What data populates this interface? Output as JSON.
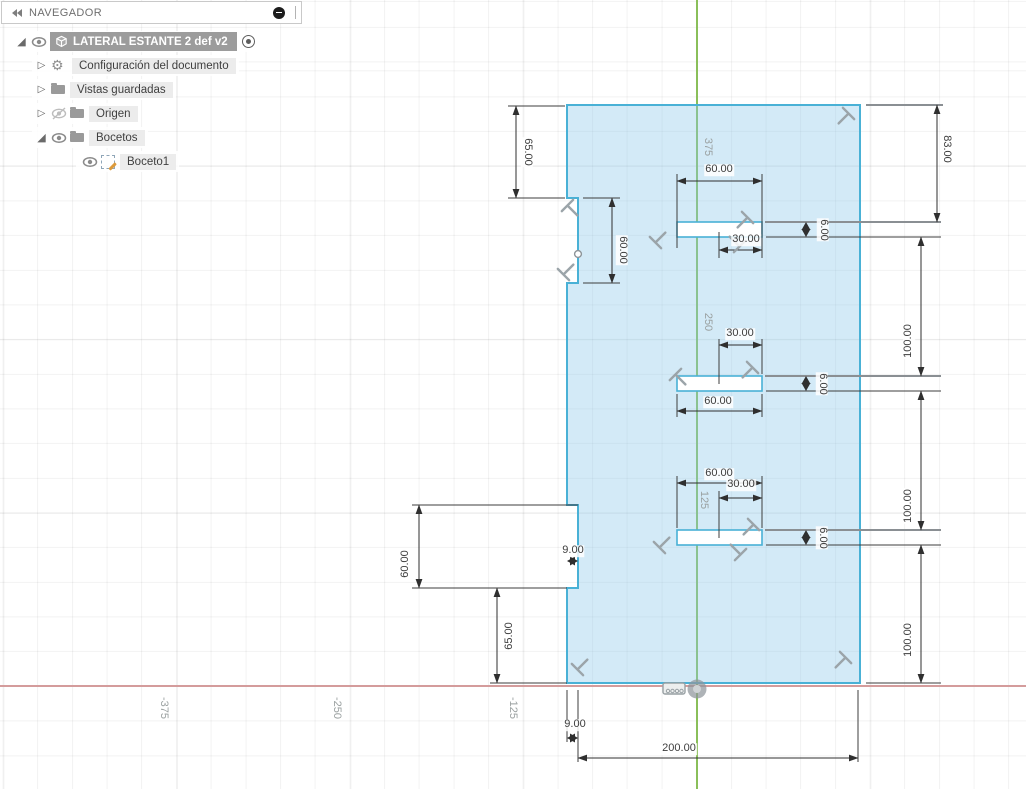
{
  "navigator": {
    "title": "NAVEGADOR",
    "icons": [
      "collapse-panel-icon",
      "panel-minus-icon",
      "panel-grip"
    ],
    "tree": [
      {
        "label": "LATERAL ESTANTE 2 def v2",
        "icon": "component-cube",
        "visible": true,
        "expanded": true,
        "selected": true,
        "activated": true
      },
      {
        "label": "Configuración del documento",
        "icon": "gear",
        "expanded": false
      },
      {
        "label": "Vistas guardadas",
        "icon": "folder",
        "expanded": false
      },
      {
        "label": "Origen",
        "icon": "folder",
        "hidden": true,
        "expanded": false
      },
      {
        "label": "Bocetos",
        "icon": "folder",
        "visible": true,
        "expanded": true
      },
      {
        "label": "Boceto1",
        "icon": "sketch",
        "visible": true,
        "child": true
      }
    ]
  },
  "canvas": {
    "axis_labels": {
      "x": [
        "-375",
        "-250",
        "-125"
      ],
      "y": [
        "375",
        "250",
        "125"
      ]
    },
    "dimensions": [
      {
        "id": "left-top-offset",
        "value": "65.00"
      },
      {
        "id": "left-notch-height",
        "value": "60.00"
      },
      {
        "id": "slot1-width",
        "value": "60.00"
      },
      {
        "id": "slot1-right-offset",
        "value": "30.00"
      },
      {
        "id": "slot1-height",
        "value": "6.00"
      },
      {
        "id": "right-top-offset",
        "value": "83.00"
      },
      {
        "id": "slot-gap-1",
        "value": "100.00"
      },
      {
        "id": "slot2-right-offset",
        "value": "30.00"
      },
      {
        "id": "slot2-width",
        "value": "60.00"
      },
      {
        "id": "slot2-height",
        "value": "6.00"
      },
      {
        "id": "slot-gap-2",
        "value": "100.00"
      },
      {
        "id": "slot3-width",
        "value": "60.00"
      },
      {
        "id": "slot3-right-offset",
        "value": "30.00"
      },
      {
        "id": "slot3-height",
        "value": "6.00"
      },
      {
        "id": "slot-gap-3",
        "value": "100.00"
      },
      {
        "id": "bottom-notch-height",
        "value": "60.00"
      },
      {
        "id": "bottom-notch-depth",
        "value": "9.00"
      },
      {
        "id": "bottom-left-offset",
        "value": "65.00"
      },
      {
        "id": "bottom-edge-offset",
        "value": "9.00"
      },
      {
        "id": "total-width",
        "value": "200.00"
      }
    ],
    "colors": {
      "sketch_fill": "#d9ecf7",
      "sketch_stroke": "#49b1d6",
      "x_axis": "#d49c9c",
      "y_axis": "#8abf5a",
      "dimension": "#3d3d3d"
    }
  }
}
